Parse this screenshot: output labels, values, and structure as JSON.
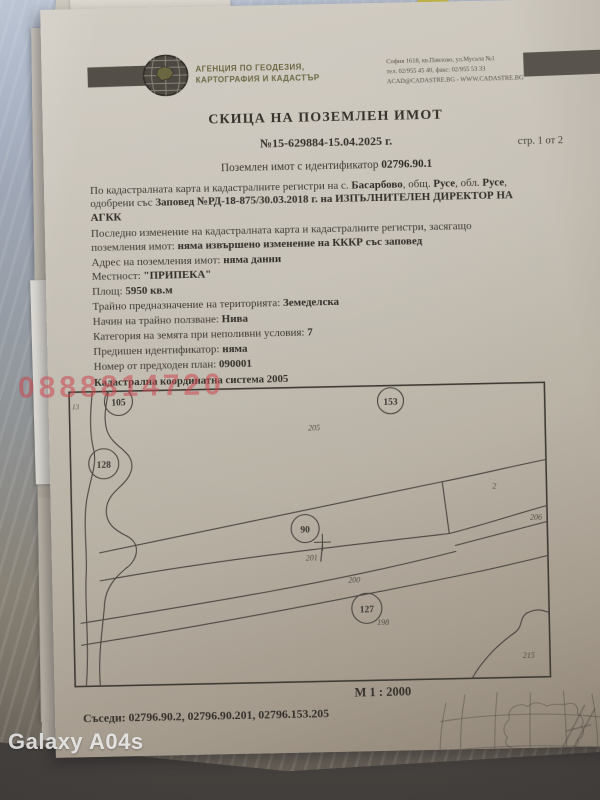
{
  "photo": {
    "camera_watermark": "Galaxy A04s",
    "phone_watermark": "0888814720"
  },
  "header": {
    "agency_line1": "АГЕНЦИЯ ПО ГЕОДЕЗИЯ,",
    "agency_line2": "КАРТОГРАФИЯ И КАДАСТЪР",
    "address_line1": "София 1618, кв.Павлово, ул.Мусала №1",
    "address_line2": "тел. 02/955 45 40, факс: 02/955 53 33",
    "address_line3": "ACAD@CADASTRE.BG - WWW.CADASTRE.BG",
    "page_indicator": "стр. 1 от 2"
  },
  "title": "СКИЦА НА ПОЗЕМЛЕН ИМОТ",
  "document_number": "№15-629884-15.04.2025 г.",
  "parcel": {
    "intro_prefix": "Поземлен имот с идентификатор ",
    "id": "02796.90.1"
  },
  "paragraph_map": {
    "seg1": "По кадастралната карта и кадастралните регистри на с. ",
    "b1": "Басарбово",
    "seg2": ", общ. ",
    "b2": "Русе",
    "seg3": ", обл. ",
    "b3": "Русе",
    "seg4": ", одобрени със ",
    "b4": "Заповед №РД-18-875/30.03.2018 г. на ИЗПЪЛНИТЕЛЕН ДИРЕКТОР НА АГКК"
  },
  "paragraph_change": {
    "seg1": "Последно изменение на кадастралната карта и кадастралните регистри, засягащо поземления имот: ",
    "b1": "няма извършено изменение на КККР със заповед"
  },
  "fields": [
    {
      "label": "Адрес на поземления имот: ",
      "value": "няма данни"
    },
    {
      "label": "Местност: ",
      "value": "\"ПРИПЕКА\""
    },
    {
      "label": "Площ: ",
      "value": "5950 кв.м"
    },
    {
      "label": "Трайно предназначение на територията: ",
      "value": "Земеделска"
    },
    {
      "label": "Начин на трайно ползване: ",
      "value": "Нива"
    },
    {
      "label": "Категория на земята при неполивни условия: ",
      "value": "7"
    },
    {
      "label": "Предишен идентификатор: ",
      "value": "няма"
    },
    {
      "label": "Номер от предходен план: ",
      "value": "090001"
    }
  ],
  "map": {
    "caption": "Кадастрална координатна система 2005",
    "scale": "М 1 : 2000",
    "labels": {
      "c105": "105",
      "c128": "128",
      "c153": "153",
      "c90": "90",
      "c127": "127",
      "n13": "13",
      "n205": "205",
      "n2": "2",
      "n206": "206",
      "n201": "201",
      "n200": "200",
      "n198": "198",
      "n215": "215"
    }
  },
  "neighbors": {
    "label": "Съседи: ",
    "value": "02796.90.2, 02796.90.201, 02796.153.205"
  },
  "footer": {
    "line1": "Скица №15-629884-15.04.2025 г.,",
    "line2": "издадена въз основа на",
    "line3": "Заявление №01-267291-03.04.2025 г.",
    "line4": "5ab3c74aaa686"
  }
}
